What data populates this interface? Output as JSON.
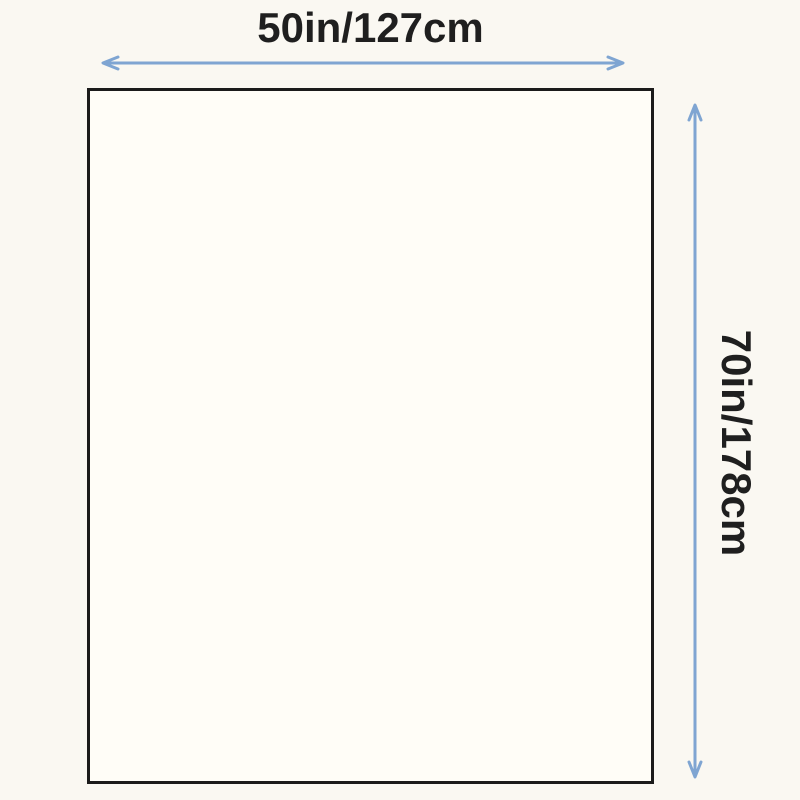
{
  "diagram": {
    "type": "product-dimension-diagram",
    "width_label": "50in/127cm",
    "height_label": "70in/178cm",
    "width_value": {
      "inches": 50,
      "centimeters": 127
    },
    "height_value": {
      "inches": 70,
      "centimeters": 178
    },
    "colors": {
      "background": "#faf8f2",
      "rect_fill": "#fffdf7",
      "rect_border": "#1b1b1b",
      "arrow": "#7fa5d2",
      "text": "#1f1f1f"
    }
  }
}
